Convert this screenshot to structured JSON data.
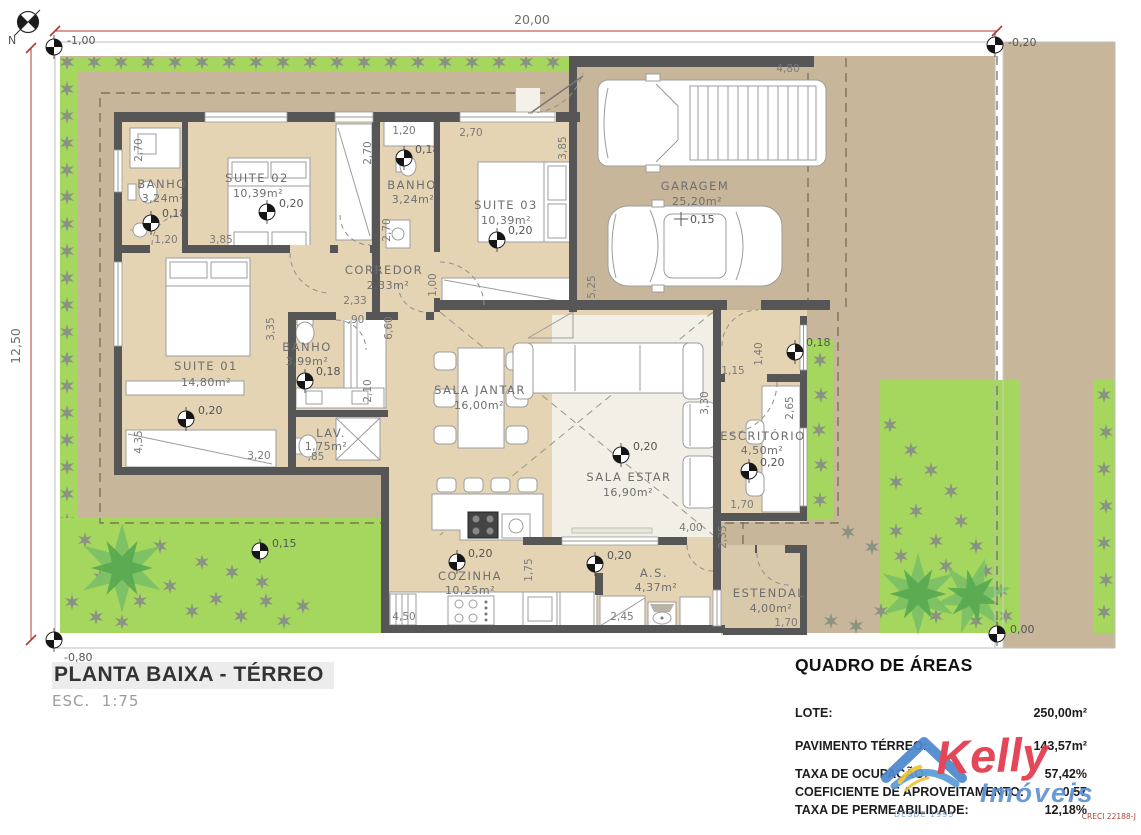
{
  "plan": {
    "north": "N",
    "red_dims": {
      "width": "20,00",
      "height": "12,50"
    },
    "levels": {
      "top_left": "-1,00",
      "top_right": "-0,20",
      "bottom_left": "-0,80",
      "bottom_right": "0,00",
      "hall": "0,18",
      "terrace": "0,15"
    },
    "rooms": [
      {
        "name": "BANHO",
        "area": "3,24m²",
        "level": "0,18"
      },
      {
        "name": "SUITE 02",
        "area": "10,39m²",
        "level": "0,20"
      },
      {
        "name": "BANHO",
        "area": "3,24m²",
        "level": "0,18"
      },
      {
        "name": "SUITE 03",
        "area": "10,39m²",
        "level": "0,20"
      },
      {
        "name": "GARAGEM",
        "area": "25,20m²",
        "level": "0,15"
      },
      {
        "name": "CORREDOR",
        "area": "2,33m²"
      },
      {
        "name": "SUITE 01",
        "area": "14,80m²",
        "level": "0,20"
      },
      {
        "name": "BANHO",
        "area": "3,99m²",
        "level": "0,18"
      },
      {
        "name": "LAV.",
        "area": "1,75m²"
      },
      {
        "name": "SALA JANTAR",
        "area": "16,00m²"
      },
      {
        "name": "SALA ESTAR",
        "area": "16,90m²",
        "level": "0,20"
      },
      {
        "name": "ESCRITÓRIO",
        "area": "4,50m²",
        "level": "0,20"
      },
      {
        "name": "COZINHA",
        "area": "10,25m²",
        "level": "0,20"
      },
      {
        "name": "A.S.",
        "area": "4,37m²",
        "level": "0,20"
      },
      {
        "name": "ESTENDAL",
        "area": "4,00m²"
      }
    ],
    "dims": [
      "2,70",
      "1,20",
      "3,85",
      "2,70",
      "1,20",
      "2,70",
      "3,85",
      "4,80",
      "2,70",
      "2,33",
      "1,00",
      "5,25",
      ",90",
      "6,60",
      "3,35",
      "2,10",
      "4,35",
      "3,20",
      ",85",
      "3,30",
      "1,15",
      "1,40",
      "2,65",
      "1,70",
      "4,00",
      "2,35",
      "4,50",
      "1,75",
      "2,45",
      "1,70"
    ]
  },
  "title_block": {
    "title": "PLANTA BAIXA - TÉRREO",
    "scale": "ESC.  1:75"
  },
  "areas_table": {
    "title": "QUADRO DE ÁREAS",
    "rows": [
      {
        "label": "LOTE:",
        "value": "250,00m²"
      },
      {
        "label": "PAVIMENTO TÉRREO:",
        "value": "143,57m²"
      },
      {
        "label": "TAXA DE OCUPAÇÃO:",
        "value": "57,42%"
      },
      {
        "label": "COEFICIENTE DE APROVEITAMENTO:",
        "value": "0,57"
      },
      {
        "label": "TAXA DE PERMEABILIDADE:",
        "value": "12,18%"
      }
    ]
  },
  "logo": {
    "brand": "Kelly",
    "type": "Imóveis",
    "since": "DESDE 1995",
    "creci": "CRECI 22188-J"
  }
}
